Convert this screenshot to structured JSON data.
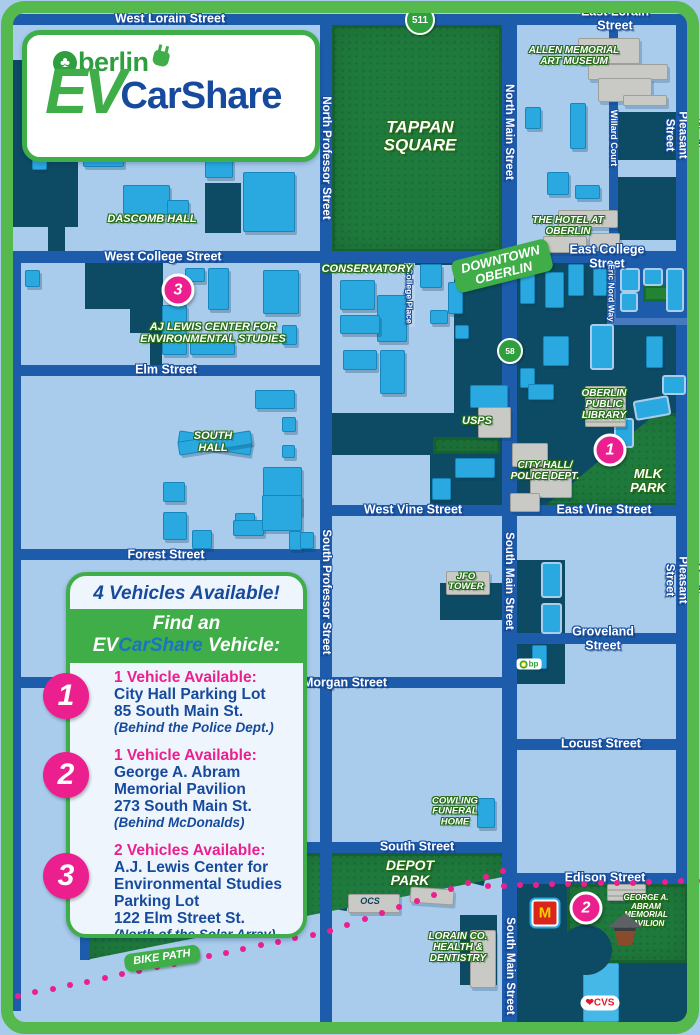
{
  "logo": {
    "brand": "Oberlin",
    "brand_rest": "berlin",
    "ev": "EV",
    "carshare": "CarShare"
  },
  "legend": {
    "header": "4 Vehicles Available!",
    "find": {
      "pre": "Find an",
      "ev": "EV",
      "carshare": "CarShare",
      "post": " Vehicle:"
    },
    "entries": [
      {
        "num": "1",
        "l0": "1 Vehicle Available:",
        "l1": "City Hall Parking Lot",
        "l2": "85 South Main St.",
        "l3": "(Behind the Police Dept.)"
      },
      {
        "num": "2",
        "l0": "1 Vehicle Available:",
        "l1": "George A. Abram",
        "l2": "Memorial Pavilion",
        "l3": "273 South Main St.",
        "l4": "(Behind McDonalds)"
      },
      {
        "num": "3",
        "l0": "2 Vehicles Available:",
        "l1": "A.J. Lewis Center for",
        "l2": "Environmental Studies",
        "l3": "Parking Lot",
        "l4": "122 Elm Street St.",
        "l5": "(North of the Solar Array)"
      }
    ]
  },
  "colors": {
    "bg": "#a9cbec",
    "street": "#1d5cab",
    "street_light": "#4779bf",
    "strip": "#b9d4ef",
    "dark": "#0d4a63",
    "cyan": "#2aa9e0",
    "park": "#1f7b3d",
    "park_bright": "#27953b",
    "gray": "#c9cac5",
    "pink": "#ec1f8f",
    "green": "#3fae49",
    "frame": "#55b94d",
    "blue_text": "#174a9c"
  },
  "map": {
    "blocks": [
      [
        12,
        60,
        66,
        167,
        "d"
      ],
      [
        48,
        227,
        17,
        25,
        "d"
      ],
      [
        12,
        77,
        18,
        35,
        "d"
      ],
      [
        205,
        183,
        36,
        50,
        "d"
      ],
      [
        617,
        112,
        71,
        48,
        "d"
      ],
      [
        617,
        177,
        71,
        63,
        "d"
      ],
      [
        85,
        263,
        78,
        46,
        "d"
      ],
      [
        130,
        309,
        33,
        24,
        "d"
      ],
      [
        150,
        333,
        12,
        33,
        "d"
      ],
      [
        330,
        263,
        173,
        243,
        "d"
      ],
      [
        517,
        263,
        171,
        243,
        "d"
      ],
      [
        440,
        583,
        64,
        37,
        "d"
      ],
      [
        517,
        560,
        48,
        74,
        "d"
      ],
      [
        517,
        640,
        48,
        44,
        "d"
      ],
      [
        517,
        884,
        171,
        139,
        "d"
      ],
      [
        460,
        915,
        37,
        70,
        "d"
      ],
      [
        435,
        858,
        52,
        22,
        "d",
        14
      ],
      [
        322,
        896,
        26,
        13,
        "d",
        10
      ],
      [
        332,
        265,
        122,
        148,
        "bg"
      ],
      [
        330,
        455,
        100,
        51,
        "bg"
      ],
      [
        612,
        263,
        76,
        61,
        "st"
      ]
    ],
    "parks": [
      {
        "x": 332,
        "y": 25,
        "w": 170,
        "h": 227
      },
      {
        "x": 545,
        "y": 413,
        "w": 143,
        "h": 93,
        "clip": "polygon(0 100%,78% 0,100% 0,100% 100%)"
      },
      {
        "x": 433,
        "y": 437,
        "w": 67,
        "h": 17
      },
      {
        "x": 85,
        "y": 853,
        "w": 420,
        "h": 107,
        "clip": "polygon(0 0,100% 0,100% 22%,0 100%)"
      },
      {
        "x": 567,
        "y": 884,
        "w": 121,
        "h": 79
      },
      {
        "x": 643,
        "y": 285,
        "w": 26,
        "h": 17,
        "c": "#27953b"
      }
    ],
    "roads": [
      [
        "west-east-lorain",
        12,
        14,
        676,
        11
      ],
      [
        "west-east-college",
        12,
        251,
        676,
        12
      ],
      [
        "elm",
        12,
        365,
        314,
        11
      ],
      [
        "vine",
        326,
        505,
        362,
        11
      ],
      [
        "forest",
        12,
        549,
        314,
        11
      ],
      [
        "groveland",
        510,
        633,
        178,
        11
      ],
      [
        "morgan",
        12,
        677,
        498,
        11
      ],
      [
        "locust",
        510,
        739,
        178,
        11
      ],
      [
        "south",
        80,
        842,
        432,
        11
      ],
      [
        "edison",
        510,
        873,
        178,
        11
      ],
      [
        "left-edge",
        12,
        251,
        9,
        760
      ],
      [
        "professor",
        320,
        14,
        12,
        1009
      ],
      [
        "main",
        502,
        14,
        15,
        1009
      ],
      [
        "pleasant",
        676,
        14,
        12,
        870
      ],
      [
        "willard-court",
        609,
        25,
        9,
        226
      ],
      [
        "south-leg",
        80,
        842,
        10,
        118
      ],
      [
        "eric-nord-v",
        607,
        263,
        9,
        62,
        "lt"
      ],
      [
        "eric-nord-h",
        607,
        318,
        81,
        7,
        "lt"
      ],
      [
        "college-place",
        404,
        263,
        11,
        64,
        "strip"
      ]
    ],
    "buildings": [
      [
        83,
        150,
        39,
        15,
        "c"
      ],
      [
        32,
        152,
        13,
        16,
        "c"
      ],
      [
        200,
        33,
        27,
        15,
        "c"
      ],
      [
        123,
        185,
        45,
        28,
        "c"
      ],
      [
        167,
        200,
        20,
        13,
        "c"
      ],
      [
        243,
        172,
        50,
        58,
        "c"
      ],
      [
        205,
        152,
        26,
        24,
        "c"
      ],
      [
        25,
        270,
        13,
        15,
        "c"
      ],
      [
        208,
        268,
        19,
        40,
        "c"
      ],
      [
        263,
        270,
        34,
        42,
        "c"
      ],
      [
        162,
        305,
        23,
        48,
        "c"
      ],
      [
        190,
        342,
        43,
        11,
        "c"
      ],
      [
        282,
        325,
        13,
        18,
        "c"
      ],
      [
        185,
        268,
        18,
        12,
        "c"
      ],
      [
        255,
        390,
        38,
        17,
        "c"
      ],
      [
        282,
        417,
        12,
        13,
        "c"
      ],
      [
        282,
        445,
        11,
        11,
        "c"
      ],
      [
        263,
        467,
        37,
        46,
        "c"
      ],
      [
        163,
        482,
        20,
        18,
        "c"
      ],
      [
        235,
        513,
        18,
        13,
        "c"
      ],
      [
        163,
        512,
        22,
        26,
        "c"
      ],
      [
        192,
        530,
        18,
        17,
        "c"
      ],
      [
        233,
        520,
        29,
        14,
        "c"
      ],
      [
        262,
        495,
        38,
        34,
        "c"
      ],
      [
        289,
        531,
        11,
        17,
        "c"
      ],
      [
        340,
        280,
        33,
        28,
        "c"
      ],
      [
        377,
        295,
        28,
        45,
        "c"
      ],
      [
        340,
        315,
        38,
        17,
        "c"
      ],
      [
        343,
        350,
        32,
        18,
        "c"
      ],
      [
        380,
        350,
        23,
        42,
        "c"
      ],
      [
        420,
        264,
        20,
        22,
        "c"
      ],
      [
        448,
        282,
        13,
        30,
        "c"
      ],
      [
        430,
        310,
        16,
        12,
        "c"
      ],
      [
        455,
        325,
        12,
        12,
        "c"
      ],
      [
        470,
        385,
        36,
        21,
        "c"
      ],
      [
        455,
        458,
        38,
        18,
        "c"
      ],
      [
        432,
        478,
        17,
        20,
        "c"
      ],
      [
        520,
        264,
        13,
        38,
        "c"
      ],
      [
        545,
        272,
        17,
        34,
        "c"
      ],
      [
        568,
        264,
        14,
        30,
        "c"
      ],
      [
        593,
        268,
        12,
        26,
        "c"
      ],
      [
        543,
        336,
        24,
        28,
        "c"
      ],
      [
        520,
        368,
        13,
        18,
        "c"
      ],
      [
        528,
        384,
        24,
        14,
        "c"
      ],
      [
        646,
        336,
        15,
        30,
        "c"
      ],
      [
        570,
        103,
        14,
        44,
        "c"
      ],
      [
        547,
        172,
        20,
        21,
        "c"
      ],
      [
        575,
        185,
        23,
        12,
        "c"
      ],
      [
        525,
        107,
        14,
        20,
        "c"
      ],
      [
        477,
        798,
        16,
        28,
        "c"
      ],
      [
        300,
        532,
        12,
        15,
        "c"
      ],
      [
        532,
        645,
        13,
        22,
        "c"
      ],
      [
        178,
        436,
        72,
        12,
        "c",
        9
      ],
      [
        178,
        436,
        72,
        12,
        "c",
        -9
      ],
      [
        590,
        324,
        20,
        42,
        "o"
      ],
      [
        634,
        398,
        32,
        16,
        "o",
        -10
      ],
      [
        614,
        418,
        16,
        26,
        "o"
      ],
      [
        662,
        375,
        20,
        16,
        "o"
      ],
      [
        620,
        268,
        16,
        20,
        "o"
      ],
      [
        643,
        268,
        16,
        14,
        "o"
      ],
      [
        666,
        268,
        14,
        40,
        "o"
      ],
      [
        620,
        292,
        14,
        16,
        "o"
      ],
      [
        541,
        562,
        17,
        32,
        "o"
      ],
      [
        541,
        603,
        17,
        27,
        "o"
      ],
      [
        578,
        38,
        60,
        24,
        "g"
      ],
      [
        588,
        64,
        78,
        14,
        "g"
      ],
      [
        598,
        78,
        52,
        22,
        "g"
      ],
      [
        623,
        95,
        42,
        9,
        "g"
      ],
      [
        558,
        210,
        58,
        16,
        "g"
      ],
      [
        543,
        236,
        42,
        15,
        "g"
      ],
      [
        589,
        233,
        29,
        13,
        "g"
      ],
      [
        478,
        407,
        31,
        29,
        "g"
      ],
      [
        512,
        443,
        34,
        22,
        "g"
      ],
      [
        530,
        468,
        40,
        28,
        "g"
      ],
      [
        510,
        493,
        28,
        17,
        "g"
      ],
      [
        348,
        894,
        50,
        17,
        "g"
      ],
      [
        410,
        888,
        42,
        14,
        "g",
        4
      ],
      [
        470,
        930,
        24,
        56,
        "g"
      ],
      [
        446,
        571,
        42,
        22,
        "g"
      ],
      [
        585,
        386,
        39,
        39,
        "gs"
      ],
      [
        607,
        884,
        37,
        15,
        "gs"
      ],
      [
        583,
        963,
        34,
        57,
        "cvs"
      ],
      [
        560,
        925,
        52,
        50,
        "n"
      ]
    ],
    "labels": [
      [
        "west-lorain-street",
        "West Lorain Street",
        170,
        19,
        12.5,
        "s"
      ],
      [
        "east-lorain-street",
        "East Lorain Street",
        615,
        19,
        12.5,
        "s"
      ],
      [
        "west-college-street",
        "West College Street",
        163,
        257,
        12.5,
        "s"
      ],
      [
        "east-college-street",
        "East College Street",
        607,
        257,
        12.5,
        "s"
      ],
      [
        "elm-street",
        "Elm Street",
        166,
        370,
        12.5,
        "s"
      ],
      [
        "west-vine-street",
        "West Vine Street",
        413,
        510,
        12.5,
        "s"
      ],
      [
        "east-vine-street",
        "East Vine Street",
        604,
        510,
        12.5,
        "s"
      ],
      [
        "forest-street",
        "Forest Street",
        166,
        555,
        12.5,
        "s"
      ],
      [
        "groveland-street",
        "Groveland Street",
        603,
        639,
        12.5,
        "s"
      ],
      [
        "morgan-street",
        "Morgan Street",
        345,
        683,
        12.5,
        "s"
      ],
      [
        "locust-street",
        "Locust Street",
        601,
        744,
        12.5,
        "s"
      ],
      [
        "south-street",
        "South Street",
        417,
        847,
        12.5,
        "s"
      ],
      [
        "edison-street",
        "Edison Street",
        605,
        878,
        12.5,
        "s"
      ],
      [
        "north-professor-street",
        "North Professor Street",
        326,
        158,
        11.5,
        "sv"
      ],
      [
        "north-main-street",
        "North Main Street",
        509,
        132,
        11.5,
        "sv"
      ],
      [
        "north-pleasant-street",
        "North Pleasant Street",
        682,
        135,
        11.5,
        "sv"
      ],
      [
        "willard-court",
        "Willard Court",
        613,
        138,
        9,
        "sv"
      ],
      [
        "college-place",
        "College Place",
        409,
        296,
        8.5,
        "sv"
      ],
      [
        "eric-nord-way",
        "Eric Nord Way",
        611,
        293,
        8.5,
        "sv"
      ],
      [
        "south-professor-street",
        "South Professor Street",
        326,
        592,
        11.5,
        "sv"
      ],
      [
        "south-main-street-1",
        "South Main Street",
        509,
        581,
        11.5,
        "sv"
      ],
      [
        "south-pleasant-street",
        "South Pleasant Street",
        682,
        580,
        11.5,
        "sv"
      ],
      [
        "south-main-street-2",
        "South Main Street",
        510,
        966,
        11.5,
        "sv"
      ],
      [
        "dascomb-hall",
        "DASCOMB HALL",
        152,
        220,
        11,
        "p"
      ],
      [
        "allen-memorial-art-museum",
        "ALLEN MEMORIAL\nART MUSEUM",
        574,
        57,
        10,
        "p"
      ],
      [
        "the-hotel-at-oberlin",
        "THE HOTEL AT\nOBERLIN",
        568,
        227,
        10,
        "p"
      ],
      [
        "tappan-square",
        "TAPPAN\nSQUARE",
        420,
        137,
        17,
        "p"
      ],
      [
        "conservatory",
        "CONSERVATORY",
        367,
        270,
        11,
        "p"
      ],
      [
        "aj-lewis-center",
        "AJ LEWIS CENTER FOR\nENVIRONMENTAL STUDIES",
        213,
        334,
        11,
        "p"
      ],
      [
        "south-hall",
        "SOUTH\nHALL",
        213,
        443,
        11,
        "p"
      ],
      [
        "usps",
        "USPS",
        477,
        422,
        11,
        "p"
      ],
      [
        "oberlin-public-library",
        "OBERLIN\nPUBLIC\nLIBRARY",
        604,
        405,
        10,
        "p"
      ],
      [
        "city-hall-police-dept",
        "CITY HALL/\nPOLICE DEPT.",
        545,
        472,
        10,
        "p"
      ],
      [
        "mlk-park",
        "MLK\nPARK",
        648,
        481,
        13,
        "p"
      ],
      [
        "jfo-tower",
        "JFO\nTOWER",
        466,
        582,
        9.5,
        "p"
      ],
      [
        "cowling-funeral-home",
        "COWLING\nFUNERAL\nHOME",
        455,
        812,
        9.5,
        "p"
      ],
      [
        "depot-park",
        "DEPOT\nPARK",
        410,
        873,
        14,
        "p"
      ],
      [
        "lorain-co-health-dentistry",
        "LORAIN CO.\nHEALTH &\nDENTISTRY",
        458,
        948,
        10,
        "p"
      ],
      [
        "george-abram-pavilion",
        "GEORGE A. ABRAM\nMEMORIAL PAVILION",
        646,
        911,
        8,
        "p"
      ],
      [
        "ocs",
        "OCS",
        370,
        902,
        9,
        "pd"
      ]
    ],
    "chips": [
      [
        "downtown-oberlin",
        "DOWNTOWN\nOBERLIN",
        502,
        266,
        -14,
        13
      ],
      [
        "bike-path",
        "BIKE PATH",
        162,
        958,
        -8,
        11
      ]
    ],
    "route_badges": [
      {
        "t": "511",
        "x": 420,
        "y": 20,
        "d": 26
      },
      {
        "t": "58",
        "x": 510,
        "y": 351,
        "d": 22
      }
    ],
    "markers": [
      {
        "n": "3",
        "x": 178,
        "y": 290
      },
      {
        "n": "1",
        "x": 610,
        "y": 450
      },
      {
        "n": "2",
        "x": 586,
        "y": 908
      }
    ],
    "bike_dots": {
      "segments": [
        [
          18,
          996,
          330,
          931,
          19
        ],
        [
          330,
          931,
          503,
          871,
          11
        ],
        [
          488,
          886,
          697,
          881,
          14
        ]
      ]
    },
    "pois": {
      "bp": {
        "t": "bp",
        "x": 529,
        "y": 664
      },
      "mcdonalds": {
        "t": "M",
        "x": 545,
        "y": 913
      },
      "cvs": {
        "t": "❤CVS",
        "x": 600,
        "y": 1003
      },
      "gazebo": {
        "x": 625,
        "y": 930
      }
    }
  }
}
